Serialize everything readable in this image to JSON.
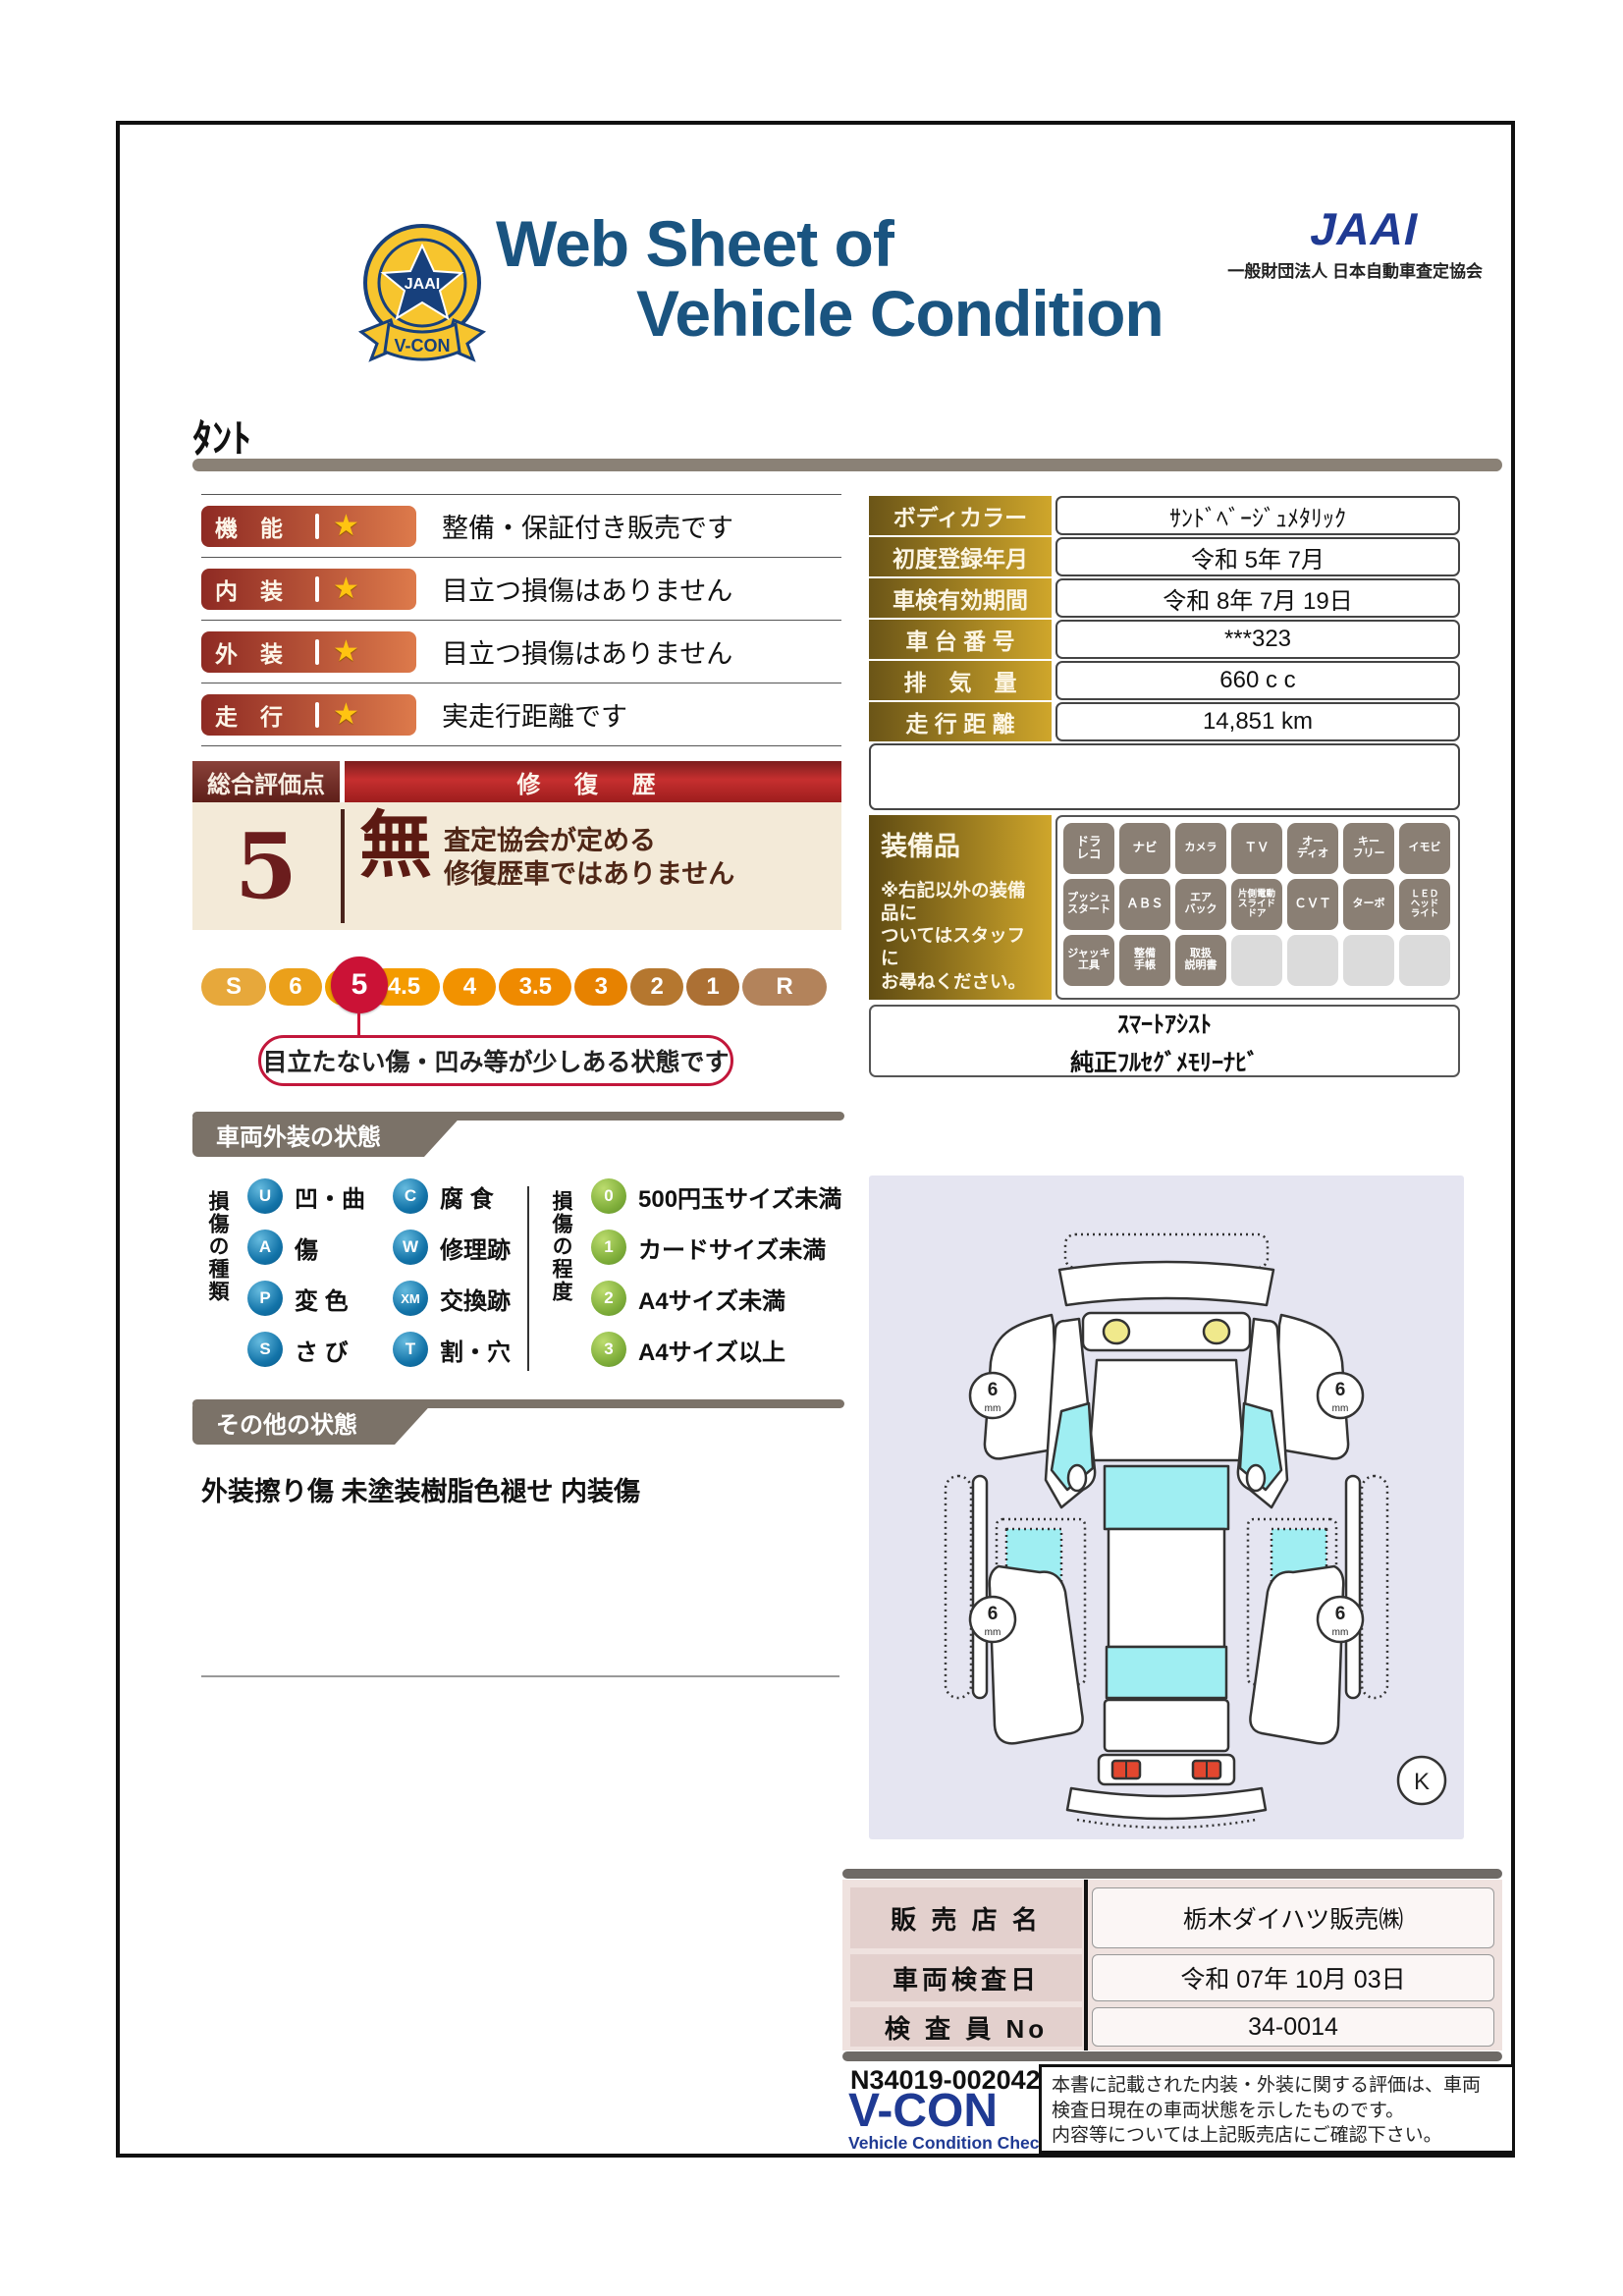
{
  "header": {
    "title_line1": "Web Sheet of",
    "title_line2": "Vehicle Condition",
    "jaai_logo": "JAAI",
    "jaai_subtitle": "一般財団法人 日本自動車査定協会",
    "emblem_text": "JAAI",
    "emblem_ribbon": "V-CON"
  },
  "vehicle_name": "ﾀﾝﾄ",
  "ratings": [
    {
      "label": "機　能",
      "text": "整備・保証付き販売です"
    },
    {
      "label": "内　装",
      "text": "目立つ損傷はありません"
    },
    {
      "label": "外　装",
      "text": "目立つ損傷はありません"
    },
    {
      "label": "走　行",
      "text": "実走行距離です"
    }
  ],
  "info_table": [
    {
      "label": "ボディカラー",
      "value": "ｻﾝﾄﾞﾍﾞｰｼﾞｭﾒﾀﾘｯｸ"
    },
    {
      "label": "初度登録年月",
      "value": "令和 5年 7月"
    },
    {
      "label": "車検有効期間",
      "value": "令和 8年 7月 19日"
    },
    {
      "label": "車 台 番 号",
      "value": "***323"
    },
    {
      "label": "排　気　量",
      "value": "660 c c"
    },
    {
      "label": "走 行 距 離",
      "value": "14,851 km"
    }
  ],
  "overall": {
    "header_left": "総合評価点",
    "header_right": "修 復 歴",
    "score": "5",
    "repair_flag": "無",
    "repair_desc": "査定協会が定める\n修復歴車ではありません",
    "callout": "目立たない傷・凹み等が少しある状態です",
    "selected": "5"
  },
  "scale_segments": [
    "S",
    "6",
    "5",
    "4.5",
    "4",
    "3.5",
    "3",
    "2",
    "1",
    "R"
  ],
  "equipment": {
    "title": "装備品",
    "note": "※右記以外の装備品に\nついてはスタッフに\nお尋ねください。",
    "badges": [
      "ドラ\nレコ",
      "ナビ",
      "カメラ",
      "ＴＶ",
      "オー\nディオ",
      "キー\nフリー",
      "イモビ",
      "プッシュ\nスタート",
      "ＡＢＳ",
      "エア\nバック",
      "片側電動\nスライド\nドア",
      "ＣＶＴ",
      "ターボ",
      "ＬＥＤ\nヘッド\nライト",
      "ジャッキ\n工具",
      "整備\n手帳",
      "取扱\n説明書"
    ],
    "extra_line1": "ｽﾏｰﾄｱｼｽﾄ",
    "extra_line2": "純正ﾌﾙｾｸﾞﾒﾓﾘｰﾅﾋﾞ"
  },
  "exterior_section": {
    "tab": "車両外装の状態",
    "type_label": "損傷の種類",
    "types": [
      {
        "code": "U",
        "label": "凹・曲"
      },
      {
        "code": "A",
        "label": "傷"
      },
      {
        "code": "P",
        "label": "変 色"
      },
      {
        "code": "S",
        "label": "さ び"
      },
      {
        "code": "C",
        "label": "腐 食"
      },
      {
        "code": "W",
        "label": "修理跡"
      },
      {
        "code": "XM",
        "label": "交換跡"
      },
      {
        "code": "T",
        "label": "割・穴"
      }
    ],
    "degree_label": "損傷の程度",
    "degrees": [
      {
        "code": "0",
        "label": "500円玉サイズ未満"
      },
      {
        "code": "1",
        "label": "カードサイズ未満"
      },
      {
        "code": "2",
        "label": "A4サイズ未満"
      },
      {
        "code": "3",
        "label": "A4サイズ以上"
      }
    ]
  },
  "other_section": {
    "tab": "その他の状態",
    "text": "外装擦り傷 未塗装樹脂色褪せ 内装傷"
  },
  "diagram": {
    "tread_value": "6",
    "tread_unit": "mm",
    "stamp": "K"
  },
  "sales": [
    {
      "label": "販 売 店 名",
      "value": "栃木ダイハツ販売㈱"
    },
    {
      "label": "車両検査日",
      "value": "令和 07年 10月 03日"
    },
    {
      "label": "検 査 員 No",
      "value": "34-0014"
    }
  ],
  "footer": {
    "serial": "N34019-002042-1",
    "vcon": "V-CON",
    "vcon_sub": "Vehicle Condition Check System",
    "note": "本書に記載された内装・外装に関する評価は、車両\n検査日現在の車両状態を示したものです。\n内容等については上記販売店にご確認下さい。"
  },
  "colors": {
    "title_blue": "#1A5480",
    "jaai_blue": "#1F3A93",
    "gold_dark": "#6B5517",
    "gold_light": "#CFA62B",
    "pill_red": "#8E2A23",
    "crimson": "#CB1236",
    "cream": "#F3EAD8",
    "tab_gray": "#7B7268",
    "badge_gray": "#8A7F74",
    "glass_cyan": "#9FEEF2"
  }
}
